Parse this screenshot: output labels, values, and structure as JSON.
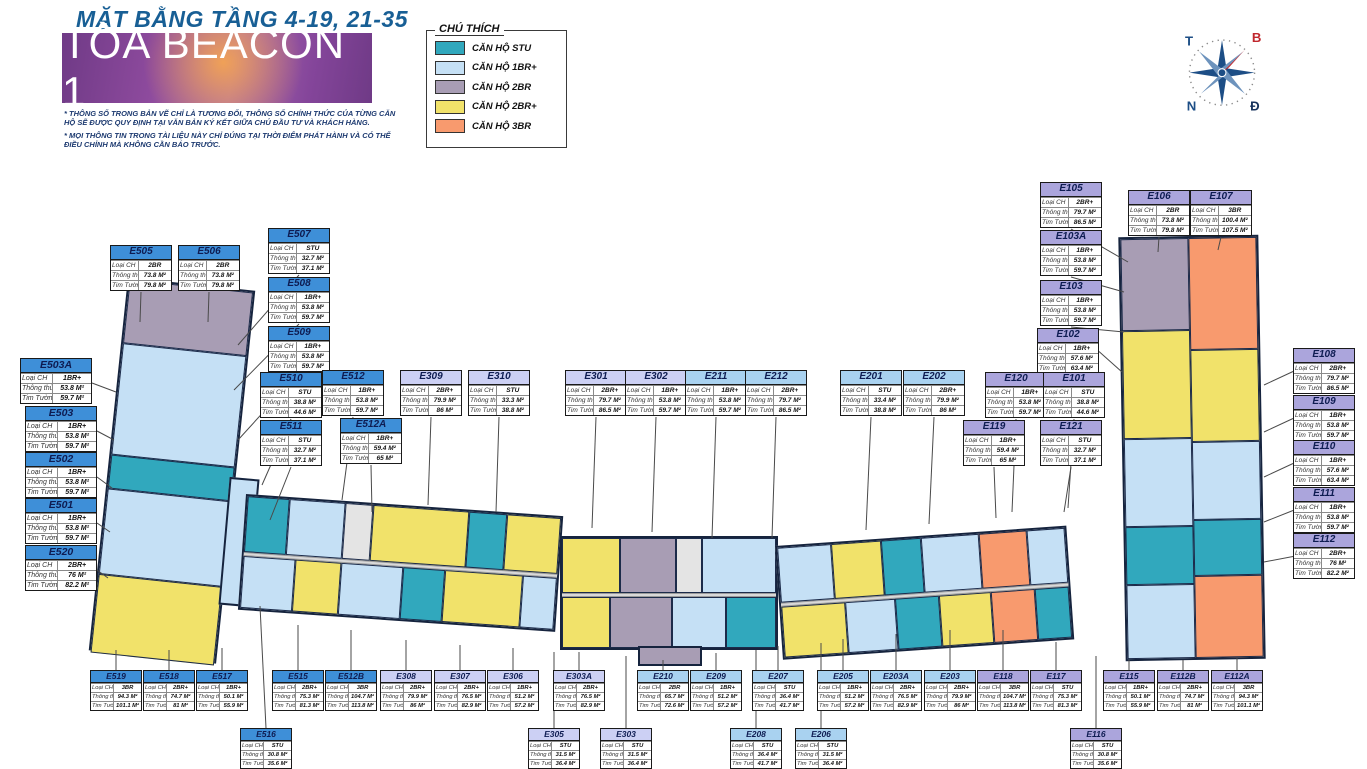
{
  "page": {
    "title": "MẶT BẰNG TẦNG 4-19, 21-35",
    "tower_name": "TÒA BEACON 1",
    "disclaimer1": "* THÔNG SỐ TRONG BẢN VẼ CHỈ LÀ TƯƠNG ĐỐI, THÔNG SỐ CHÍNH THỨC CỦA TỪNG CĂN HỘ SẼ ĐƯỢC QUY ĐỊNH TẠI VĂN BẢN KÝ KẾT GIỮA CHỦ ĐẦU TƯ VÀ KHÁCH HÀNG.",
    "disclaimer2": "* MỌI THÔNG TIN TRONG TÀI LIỆU NÀY CHỈ ĐÚNG TẠI THỜI ĐIỂM PHÁT HÀNH VÀ CÓ THỂ ĐIỀU CHỈNH MÀ KHÔNG CẦN BÁO TRƯỚC."
  },
  "legend": {
    "title": "CHÚ THÍCH",
    "items": [
      {
        "label": "CĂN HỘ STU",
        "color": "#31a8bd"
      },
      {
        "label": "CĂN HỘ 1BR+",
        "color": "#c5e0f5"
      },
      {
        "label": "CĂN HỘ 2BR",
        "color": "#a89db4"
      },
      {
        "label": "CĂN HỘ 2BR+",
        "color": "#f1e26a"
      },
      {
        "label": "CĂN HỘ 3BR",
        "color": "#f89a6e"
      }
    ]
  },
  "compass": {
    "top_left": "T",
    "top_right": "B",
    "bottom_left": "N",
    "bottom_right": "Đ"
  },
  "callout_labels": {
    "type": "Loại CH",
    "net": "Thông thủy",
    "gross": "Tim Tường"
  },
  "group_colors": {
    "E5": "#3e8fd8",
    "E3": "#ccd0f4",
    "E2": "#a9d2f0",
    "E1": "#aba5dc"
  },
  "units": [
    {
      "id": "E505",
      "type": "2BR",
      "net": "73.8 M²",
      "gross": "79.8 M²",
      "g": "E5",
      "sz": "md",
      "x": 110,
      "y": 245,
      "lx": 140,
      "ly": 322
    },
    {
      "id": "E506",
      "type": "2BR",
      "net": "73.8 M²",
      "gross": "79.8 M²",
      "g": "E5",
      "sz": "md",
      "x": 178,
      "y": 245,
      "lx": 208,
      "ly": 322
    },
    {
      "id": "E507",
      "type": "STU",
      "net": "32.7 M²",
      "gross": "37.1 M²",
      "g": "E5",
      "sz": "md",
      "x": 268,
      "y": 228,
      "lx": 238,
      "ly": 345
    },
    {
      "id": "E508",
      "type": "1BR+",
      "net": "53.8 M²",
      "gross": "59.7 M²",
      "g": "E5",
      "sz": "md",
      "x": 268,
      "y": 277,
      "lx": 234,
      "ly": 390
    },
    {
      "id": "E509",
      "type": "1BR+",
      "net": "53.8 M²",
      "gross": "59.7 M²",
      "g": "E5",
      "sz": "md",
      "x": 268,
      "y": 326,
      "lx": 238,
      "ly": 440
    },
    {
      "id": "E510",
      "type": "STU",
      "net": "38.8 M²",
      "gross": "44.6 M²",
      "g": "E5",
      "sz": "md",
      "x": 260,
      "y": 372,
      "lx": 262,
      "ly": 485
    },
    {
      "id": "E512",
      "type": "1BR+",
      "net": "53.8 M²",
      "gross": "59.7 M²",
      "g": "E5",
      "sz": "md",
      "x": 322,
      "y": 370,
      "lx": 342,
      "ly": 500
    },
    {
      "id": "E511",
      "type": "STU",
      "net": "32.7 M²",
      "gross": "37.1 M²",
      "g": "E5",
      "sz": "md",
      "x": 260,
      "y": 420,
      "lx": 270,
      "ly": 520
    },
    {
      "id": "E512A",
      "type": "1BR+",
      "net": "59.4 M²",
      "gross": "65 M²",
      "g": "E5",
      "sz": "md",
      "x": 340,
      "y": 418,
      "lx": 372,
      "ly": 512
    },
    {
      "id": "E503A",
      "type": "1BR+",
      "net": "53.8 M²",
      "gross": "59.7 M²",
      "g": "E5",
      "sz": "lg",
      "x": 20,
      "y": 358,
      "lx": 116,
      "ly": 392
    },
    {
      "id": "E503",
      "type": "1BR+",
      "net": "53.8 M²",
      "gross": "59.7 M²",
      "g": "E5",
      "sz": "lg",
      "x": 25,
      "y": 406,
      "lx": 114,
      "ly": 440
    },
    {
      "id": "E502",
      "type": "1BR+",
      "net": "53.8 M²",
      "gross": "59.7 M²",
      "g": "E5",
      "sz": "lg",
      "x": 25,
      "y": 452,
      "lx": 112,
      "ly": 488
    },
    {
      "id": "E501",
      "type": "1BR+",
      "net": "53.8 M²",
      "gross": "59.7 M²",
      "g": "E5",
      "sz": "lg",
      "x": 25,
      "y": 498,
      "lx": 110,
      "ly": 532
    },
    {
      "id": "E520",
      "type": "2BR+",
      "net": "76 M²",
      "gross": "82.2 M²",
      "g": "E5",
      "sz": "lg",
      "x": 25,
      "y": 545,
      "lx": 108,
      "ly": 578
    },
    {
      "id": "E519",
      "type": "3BR",
      "net": "94.3 M²",
      "gross": "101.1 M²",
      "g": "E5",
      "sz": "sm",
      "x": 90,
      "y": 670,
      "lx": 116,
      "ly": 650
    },
    {
      "id": "E518",
      "type": "2BR+",
      "net": "74.7 M²",
      "gross": "81 M²",
      "g": "E5",
      "sz": "sm",
      "x": 143,
      "y": 670,
      "lx": 169,
      "ly": 650
    },
    {
      "id": "E517",
      "type": "1BR+",
      "net": "50.1 M²",
      "gross": "55.9 M²",
      "g": "E5",
      "sz": "sm",
      "x": 196,
      "y": 670,
      "lx": 222,
      "ly": 648
    },
    {
      "id": "E516",
      "type": "STU",
      "net": "30.8 M²",
      "gross": "35.6 M²",
      "g": "E5",
      "sz": "sm",
      "x": 240,
      "y": 728,
      "lx": 260,
      "ly": 606
    },
    {
      "id": "E515",
      "type": "2BR+",
      "net": "75.3 M²",
      "gross": "81.3 M²",
      "g": "E5",
      "sz": "sm",
      "x": 272,
      "y": 670,
      "lx": 298,
      "ly": 625
    },
    {
      "id": "E512B",
      "type": "3BR",
      "net": "104.7 M²",
      "gross": "113.8 M²",
      "g": "E5",
      "sz": "sm",
      "x": 325,
      "y": 670,
      "lx": 351,
      "ly": 630
    },
    {
      "id": "E309",
      "type": "2BR+",
      "net": "79.9 M²",
      "gross": "86 M²",
      "g": "E3",
      "sz": "md",
      "x": 400,
      "y": 370,
      "lx": 428,
      "ly": 505
    },
    {
      "id": "E310",
      "type": "STU",
      "net": "33.3 M²",
      "gross": "38.8 M²",
      "g": "E3",
      "sz": "md",
      "x": 468,
      "y": 370,
      "lx": 496,
      "ly": 512
    },
    {
      "id": "E301",
      "type": "2BR+",
      "net": "79.7 M²",
      "gross": "86.5 M²",
      "g": "E3",
      "sz": "md",
      "x": 565,
      "y": 370,
      "lx": 592,
      "ly": 528
    },
    {
      "id": "E302",
      "type": "1BR+",
      "net": "53.8 M²",
      "gross": "59.7 M²",
      "g": "E3",
      "sz": "md",
      "x": 625,
      "y": 370,
      "lx": 652,
      "ly": 532
    },
    {
      "id": "E308",
      "type": "2BR+",
      "net": "79.9 M²",
      "gross": "86 M²",
      "g": "E3",
      "sz": "sm",
      "x": 380,
      "y": 670,
      "lx": 406,
      "ly": 640
    },
    {
      "id": "E307",
      "type": "2BR+",
      "net": "76.5 M²",
      "gross": "82.9 M²",
      "g": "E3",
      "sz": "sm",
      "x": 434,
      "y": 670,
      "lx": 460,
      "ly": 645
    },
    {
      "id": "E306",
      "type": "1BR+",
      "net": "51.2 M²",
      "gross": "57.2 M²",
      "g": "E3",
      "sz": "sm",
      "x": 487,
      "y": 670,
      "lx": 513,
      "ly": 648
    },
    {
      "id": "E305",
      "type": "STU",
      "net": "31.5 M²",
      "gross": "36.4 M²",
      "g": "E3",
      "sz": "sm",
      "x": 528,
      "y": 728,
      "lx": 554,
      "ly": 652
    },
    {
      "id": "E303A",
      "type": "2BR+",
      "net": "76.5 M²",
      "gross": "82.9 M²",
      "g": "E3",
      "sz": "sm",
      "x": 553,
      "y": 670,
      "lx": 579,
      "ly": 652
    },
    {
      "id": "E303",
      "type": "STU",
      "net": "31.5 M²",
      "gross": "36.4 M²",
      "g": "E3",
      "sz": "sm",
      "x": 600,
      "y": 728,
      "lx": 626,
      "ly": 656
    },
    {
      "id": "E211",
      "type": "1BR+",
      "net": "53.8 M²",
      "gross": "59.7 M²",
      "g": "E2",
      "sz": "md",
      "x": 685,
      "y": 370,
      "lx": 712,
      "ly": 538
    },
    {
      "id": "E212",
      "type": "2BR+",
      "net": "79.7 M²",
      "gross": "86.5 M²",
      "g": "E2",
      "sz": "md",
      "x": 745,
      "y": 370,
      "lx": 772,
      "ly": 538
    },
    {
      "id": "E201",
      "type": "STU",
      "net": "33.4 M²",
      "gross": "38.8 M²",
      "g": "E2",
      "sz": "md",
      "x": 840,
      "y": 370,
      "lx": 866,
      "ly": 530
    },
    {
      "id": "E202",
      "type": "2BR+",
      "net": "79.9 M²",
      "gross": "86 M²",
      "g": "E2",
      "sz": "md",
      "x": 903,
      "y": 370,
      "lx": 929,
      "ly": 524
    },
    {
      "id": "E210",
      "type": "2BR",
      "net": "65.7 M²",
      "gross": "72.6 M²",
      "g": "E2",
      "sz": "sm",
      "x": 637,
      "y": 670,
      "lx": 663,
      "ly": 660
    },
    {
      "id": "E209",
      "type": "1BR+",
      "net": "51.2 M²",
      "gross": "57.2 M²",
      "g": "E2",
      "sz": "sm",
      "x": 690,
      "y": 670,
      "lx": 716,
      "ly": 653
    },
    {
      "id": "E208",
      "type": "STU",
      "net": "36.4 M²",
      "gross": "41.7 M²",
      "g": "E2",
      "sz": "sm",
      "x": 730,
      "y": 728,
      "lx": 756,
      "ly": 650
    },
    {
      "id": "E207",
      "type": "STU",
      "net": "36.4 M²",
      "gross": "41.7 M²",
      "g": "E2",
      "sz": "sm",
      "x": 752,
      "y": 670,
      "lx": 778,
      "ly": 646
    },
    {
      "id": "E206",
      "type": "STU",
      "net": "31.5 M²",
      "gross": "36.4 M²",
      "g": "E2",
      "sz": "sm",
      "x": 795,
      "y": 728,
      "lx": 821,
      "ly": 643
    },
    {
      "id": "E205",
      "type": "1BR+",
      "net": "51.2 M²",
      "gross": "57.2 M²",
      "g": "E2",
      "sz": "sm",
      "x": 817,
      "y": 670,
      "lx": 843,
      "ly": 639
    },
    {
      "id": "E203A",
      "type": "2BR+",
      "net": "76.5 M²",
      "gross": "82.9 M²",
      "g": "E2",
      "sz": "sm",
      "x": 870,
      "y": 670,
      "lx": 896,
      "ly": 634
    },
    {
      "id": "E203",
      "type": "2BR+",
      "net": "79.9 M²",
      "gross": "86 M²",
      "g": "E2",
      "sz": "sm",
      "x": 924,
      "y": 670,
      "lx": 950,
      "ly": 630
    },
    {
      "id": "E105",
      "type": "2BR+",
      "net": "79.7 M²",
      "gross": "86.5 M²",
      "g": "E1",
      "sz": "md",
      "x": 1040,
      "y": 182,
      "lx": 1128,
      "ly": 262
    },
    {
      "id": "E106",
      "type": "2BR",
      "net": "73.8 M²",
      "gross": "79.8 M²",
      "g": "E1",
      "sz": "md",
      "x": 1128,
      "y": 190,
      "lx": 1158,
      "ly": 252
    },
    {
      "id": "E107",
      "type": "3BR",
      "net": "100.4 M²",
      "gross": "107.5 M²",
      "g": "E1",
      "sz": "md",
      "x": 1190,
      "y": 190,
      "lx": 1218,
      "ly": 250
    },
    {
      "id": "E103A",
      "type": "1BR+",
      "net": "53.8 M²",
      "gross": "59.7 M²",
      "g": "E1",
      "sz": "md",
      "x": 1040,
      "y": 230,
      "lx": 1124,
      "ly": 292
    },
    {
      "id": "E103",
      "type": "1BR+",
      "net": "53.8 M²",
      "gross": "59.7 M²",
      "g": "E1",
      "sz": "md",
      "x": 1040,
      "y": 280,
      "lx": 1124,
      "ly": 332
    },
    {
      "id": "E102",
      "type": "1BR+",
      "net": "57.6 M²",
      "gross": "63.4 M²",
      "g": "E1",
      "sz": "md",
      "x": 1037,
      "y": 328,
      "lx": 1122,
      "ly": 372
    },
    {
      "id": "E120",
      "type": "1BR+",
      "net": "53.8 M²",
      "gross": "59.7 M²",
      "g": "E1",
      "sz": "md",
      "x": 985,
      "y": 372,
      "lx": 1012,
      "ly": 512
    },
    {
      "id": "E101",
      "type": "STU",
      "net": "38.8 M²",
      "gross": "44.6 M²",
      "g": "E1",
      "sz": "md",
      "x": 1043,
      "y": 372,
      "lx": 1068,
      "ly": 508
    },
    {
      "id": "E119",
      "type": "1BR+",
      "net": "59.4 M²",
      "gross": "65 M²",
      "g": "E1",
      "sz": "md",
      "x": 963,
      "y": 420,
      "lx": 996,
      "ly": 518
    },
    {
      "id": "E121",
      "type": "STU",
      "net": "32.7 M²",
      "gross": "37.1 M²",
      "g": "E1",
      "sz": "md",
      "x": 1040,
      "y": 420,
      "lx": 1064,
      "ly": 512
    },
    {
      "id": "E108",
      "type": "2BR+",
      "net": "79.7 M²",
      "gross": "86.5 M²",
      "g": "E1",
      "sz": "md",
      "x": 1293,
      "y": 348,
      "lx": 1264,
      "ly": 385
    },
    {
      "id": "E109",
      "type": "1BR+",
      "net": "53.8 M²",
      "gross": "59.7 M²",
      "g": "E1",
      "sz": "md",
      "x": 1293,
      "y": 395,
      "lx": 1264,
      "ly": 432
    },
    {
      "id": "E110",
      "type": "1BR+",
      "net": "57.6 M²",
      "gross": "63.4 M²",
      "g": "E1",
      "sz": "md",
      "x": 1293,
      "y": 440,
      "lx": 1264,
      "ly": 477
    },
    {
      "id": "E111",
      "type": "1BR+",
      "net": "53.8 M²",
      "gross": "59.7 M²",
      "g": "E1",
      "sz": "md",
      "x": 1293,
      "y": 487,
      "lx": 1264,
      "ly": 522
    },
    {
      "id": "E112",
      "type": "2BR+",
      "net": "76 M²",
      "gross": "82.2 M²",
      "g": "E1",
      "sz": "md",
      "x": 1293,
      "y": 533,
      "lx": 1264,
      "ly": 562
    },
    {
      "id": "E118",
      "type": "3BR",
      "net": "104.7 M²",
      "gross": "113.8 M²",
      "g": "E1",
      "sz": "sm",
      "x": 977,
      "y": 670,
      "lx": 1003,
      "ly": 630
    },
    {
      "id": "E117",
      "type": "STU",
      "net": "75.3 M²",
      "gross": "81.3 M²",
      "g": "E1",
      "sz": "sm",
      "x": 1030,
      "y": 670,
      "lx": 1056,
      "ly": 642
    },
    {
      "id": "E116",
      "type": "STU",
      "net": "30.8 M²",
      "gross": "35.6 M²",
      "g": "E1",
      "sz": "sm",
      "x": 1070,
      "y": 728,
      "lx": 1096,
      "ly": 656
    },
    {
      "id": "E115",
      "type": "1BR+",
      "net": "50.1 M²",
      "gross": "55.9 M²",
      "g": "E1",
      "sz": "sm",
      "x": 1103,
      "y": 670,
      "lx": 1129,
      "ly": 660
    },
    {
      "id": "E112B",
      "type": "2BR+",
      "net": "74.7 M²",
      "gross": "81 M²",
      "g": "E1",
      "sz": "sm",
      "x": 1157,
      "y": 670,
      "lx": 1183,
      "ly": 660
    },
    {
      "id": "E112A",
      "type": "3BR",
      "net": "94.3 M²",
      "gross": "101.1 M²",
      "g": "E1",
      "sz": "sm",
      "x": 1211,
      "y": 670,
      "lx": 1237,
      "ly": 658
    }
  ]
}
